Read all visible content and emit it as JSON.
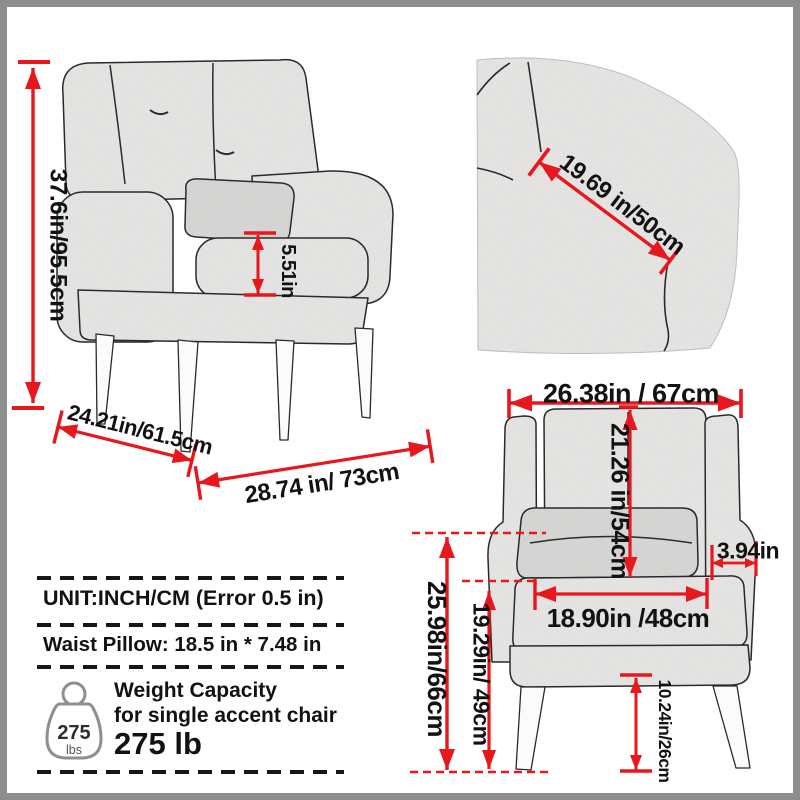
{
  "colors": {
    "accent_red": "#e8161d",
    "ink": "#121212",
    "fabric_fill": "#efeeec",
    "frame_gray": "#8d8d8d"
  },
  "side_view": {
    "overall_height_label": "37.6in/95.5cm",
    "armrest_thickness_label": "5.51in",
    "seat_depth_label": "24.21in/61.5cm",
    "overall_depth_label": "28.74 in/ 73cm"
  },
  "fabric_closeup": {
    "back_width_label": "19.69 in/50cm"
  },
  "front_view": {
    "overall_width_label": "26.38in / 67cm",
    "back_height_label": "21.26 in/54cm",
    "armrest_width_label": "3.94in",
    "seat_width_label": "18.90in /48cm",
    "overall_height_label": "25.98in/66cm",
    "arm_height_label": "19.29in/ 49cm",
    "leg_height_label": "10.24in/26cm"
  },
  "info_box": {
    "unit_line": "UNIT:INCH/CM (Error 0.5 in)",
    "pillow_line": "Waist Pillow: 18.5 in * 7.48 in",
    "weight_title": "Weight Capacity",
    "weight_subtitle": "for single accent chair",
    "weight_value": "275 lb",
    "weight_icon": {
      "value": "275",
      "unit": "lbs"
    }
  }
}
